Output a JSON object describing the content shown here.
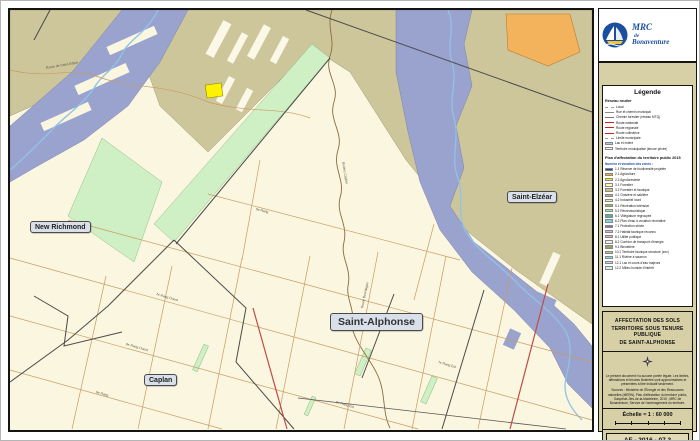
{
  "logo": {
    "line1": "MRC",
    "line2": "de",
    "line3": "Bonaventure"
  },
  "map": {
    "place_labels": [
      "New Richmond",
      "Saint-Elzéar",
      "Saint-Alphonse",
      "Caplan"
    ],
    "road_labels": [
      "Route de Saint-Edgar",
      "Rivière Caplan",
      "6e Rang",
      "7e Rang Ouest",
      "7e Rang Est",
      "8e Rang Ouest",
      "8e Rang Est",
      "Route Bourdages",
      "9e Rang"
    ]
  },
  "legend": {
    "title": "Légende",
    "network_header": "Réseau routier",
    "network_items": [
      {
        "label": "Local",
        "swatch": "line",
        "color": "#9a9a9a",
        "style": "dashed"
      },
      {
        "label": "Rue et chemin municipal",
        "swatch": "line",
        "color": "#8a8a8a",
        "style": "solid"
      },
      {
        "label": "Chemin forestier (réseau MTQ)",
        "swatch": "line",
        "color": "#777777",
        "style": "solid"
      },
      {
        "label": "Route nationale",
        "swatch": "line",
        "color": "#cc2222",
        "style": "solid"
      },
      {
        "label": "Route régionale",
        "swatch": "line",
        "color": "#cc2222",
        "style": "solid"
      },
      {
        "label": "Route collectrice",
        "swatch": "line",
        "color": "#cc2222",
        "style": "solid"
      },
      {
        "label": "Limite municipale",
        "swatch": "line",
        "color": "#999999",
        "style": "dashed"
      },
      {
        "label": "Lac et rivière",
        "swatch": "fill",
        "color": "#AFCBE8"
      },
      {
        "label": "Territoire municipalisé (tenure privée)",
        "swatch": "fill",
        "color": "#FDFBEA"
      }
    ],
    "plan_header": "Plan d'affectation du territoire public 2015",
    "plan_subheader": "Numéro et vocation des zones :",
    "plan_items": [
      {
        "code": "1.1",
        "label": "Réserve de biodiversité projetée",
        "color": "#2C3E8F"
      },
      {
        "code": "2.1",
        "label": "Agriculture",
        "color": "#F4A63C"
      },
      {
        "code": "2.2",
        "label": "Agroforesterie",
        "color": "#FFF200"
      },
      {
        "code": "3.1",
        "label": "Forestier",
        "color": "#FFF7B2"
      },
      {
        "code": "3.2",
        "label": "Forestier et faunique",
        "color": "#CBC386"
      },
      {
        "code": "4.1",
        "label": "Gravière et sablière",
        "color": "#C7A36B"
      },
      {
        "code": "4.2",
        "label": "Industriel lourd",
        "color": "#DCEFC9"
      },
      {
        "code": "5.1",
        "label": "Récréation intensive",
        "color": "#8CC63F"
      },
      {
        "code": "5.2",
        "label": "Récréotouristique",
        "color": "#B8E0A2"
      },
      {
        "code": "6.1",
        "label": "Villégiature regroupée",
        "color": "#4FB3A0"
      },
      {
        "code": "6.2",
        "label": "Plan d'eau à vocation récréative",
        "color": "#7FD4E8"
      },
      {
        "code": "7.1",
        "label": "Protection stricte",
        "color": "#8E6FB8"
      },
      {
        "code": "7.2",
        "label": "Habitat faunique reconnu",
        "color": "#CBB8E6"
      },
      {
        "code": "8.1",
        "label": "Utilité publique",
        "color": "#F2A6C4"
      },
      {
        "code": "8.2",
        "label": "Corridor de transport d'énergie",
        "color": "#EDEDED"
      },
      {
        "code": "9.1",
        "label": "Bleuetière",
        "color": "#9BA05A"
      },
      {
        "code": "10.1",
        "label": "Territoire faunique structuré (zec)",
        "color": "#A9C4A0"
      },
      {
        "code": "11.1",
        "label": "Rivière à saumon",
        "color": "#7FE8D4"
      },
      {
        "code": "12.1",
        "label": "Lac et cours d'eau majeurs",
        "color": "#BFD8EE"
      },
      {
        "code": "12.2",
        "label": "Milieu humide d'intérêt",
        "color": "#D6EFE8"
      }
    ]
  },
  "title_block": {
    "line1": "AFFECTATION DES SOLS",
    "line2": "TERRITOIRE SOUS TENURE PUBLIQUE",
    "line3": "DE SAINT-ALPHONSE",
    "disclaimer": "Le présent document n'a aucune portée légale. Les limites, affectations et tenures illustrées sont approximatives et présentées à titre indicatif seulement.",
    "sources": "Sources : Ministère de l'Énergie et des Ressources naturelles (MERN), Plan d'affectation du territoire public, Gaspésie–Îles-de-la-Madeleine, 2015 ; MRC de Bonaventure, Service de l'aménagement du territoire.",
    "scale_label": "Échelle ≈ 1 : 60 000",
    "sheet_code": "AF - 2016 - 07.3"
  },
  "colors": {
    "map_background": "#FBF6DF",
    "public_forest": "#CEC69B",
    "affectation_blue": "#9AA2CE",
    "green_zone": "#CFEFC4",
    "orange_zone": "#F2B35C",
    "yellow_zone": "#FFF200",
    "water_line": "#8FC3E8",
    "stream": "#8A6B42",
    "road": "#C89B63",
    "highway": "#BE4B48",
    "panel_tan": "#D7CFA6",
    "logo_blue": "#1C4E9E"
  }
}
